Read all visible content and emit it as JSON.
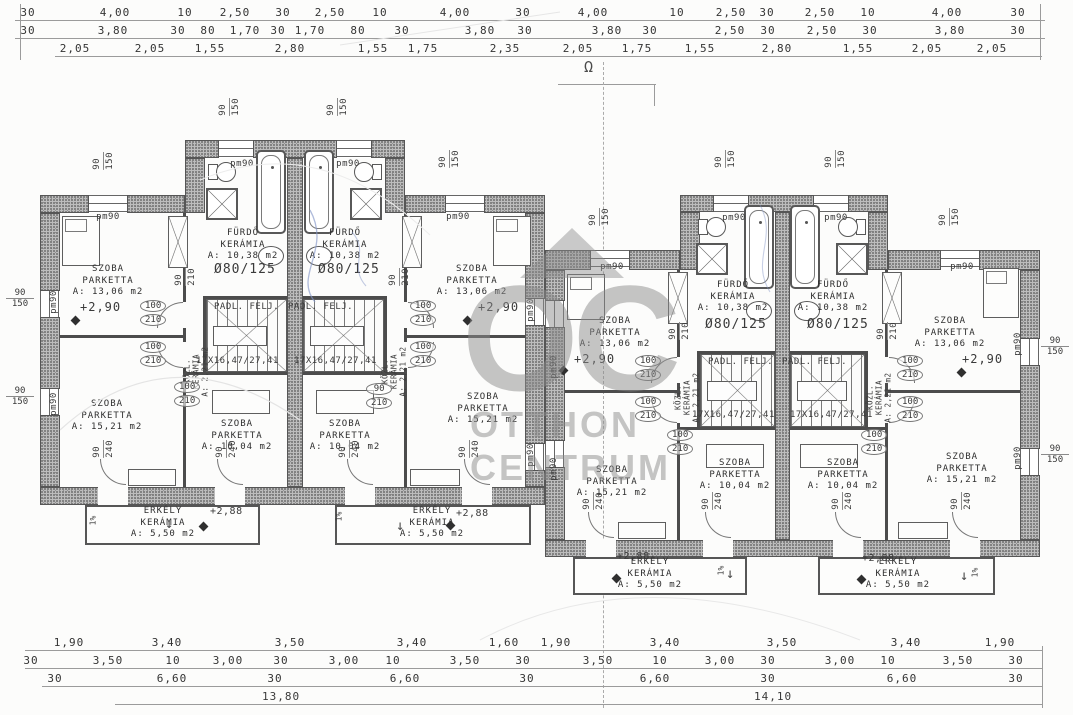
{
  "watermark": {
    "initials": "OC",
    "line1": "OTTHON",
    "line2": "CENTRUM"
  },
  "section_symbol": "Ω",
  "dimensions": {
    "top": {
      "row1": [
        "30",
        "4,00",
        "10",
        "2,50",
        "30",
        "2,50",
        "10",
        "4,00",
        "30",
        "4,00",
        "10",
        "2,50",
        "30",
        "2,50",
        "10",
        "4,00",
        "30"
      ],
      "row2": [
        "30",
        "3,80",
        "30",
        "80",
        "1,70",
        "30",
        "1,70",
        "80",
        "30",
        "3,80",
        "30",
        "3,80",
        "30",
        "2,50",
        "30",
        "2,50",
        "30",
        "3,80",
        "30"
      ],
      "row3": [
        "2,05",
        "2,05",
        "1,55",
        "2,80",
        "1,55",
        "1,75",
        "2,35",
        "2,05",
        "1,75",
        "1,55",
        "2,80",
        "1,55",
        "2,05",
        "2,05"
      ]
    },
    "bottom": {
      "row1": [
        "1,90",
        "3,40",
        "3,50",
        "3,40",
        "1,60",
        "1,90",
        "3,40",
        "3,50",
        "3,40",
        "1,90"
      ],
      "row2": [
        "30",
        "3,50",
        "10",
        "3,00",
        "30",
        "3,00",
        "10",
        "3,50",
        "30",
        "3,50",
        "10",
        "3,00",
        "30",
        "3,00",
        "10",
        "3,50",
        "30"
      ],
      "row3": [
        "30",
        "6,60",
        "30",
        "6,60",
        "30",
        "6,60",
        "30",
        "6,60",
        "30"
      ],
      "totals": {
        "left": "13,80",
        "right": "14,10"
      }
    }
  },
  "rooms": [
    {
      "name": "SZOBA",
      "finish": "PARKETTA",
      "area": "A: 13,06 m2"
    },
    {
      "name": "SZOBA",
      "finish": "PARKETTA",
      "area": "A: 15,21 m2"
    },
    {
      "name": "FÜRDŐ",
      "finish": "KERÁMIA",
      "area": "A: 10,38 m2"
    },
    {
      "name": "SZOBA",
      "finish": "PARKETTA",
      "area": "A: 10,04 m2"
    },
    {
      "name": "ERKÉLY",
      "finish": "KERÁMIA",
      "area": "A: 5,50 m2"
    },
    {
      "name": "SZOBA",
      "finish": "PARKETTA",
      "area": "A: 13,06 m2"
    },
    {
      "name": "SZOBA",
      "finish": "PARKETTA",
      "area": "A: 15,21 m2"
    },
    {
      "name": "FÜRDŐ",
      "finish": "KERÁMIA",
      "area": "A: 10,38 m2"
    },
    {
      "name": "SZOBA",
      "finish": "PARKETTA",
      "area": "A: 10,04 m2"
    },
    {
      "name": "ERKÉLY",
      "finish": "KERÁMIA",
      "area": "A: 5,50 m2"
    },
    {
      "name": "SZOBA",
      "finish": "PARKETTA",
      "area": "A: 13,06 m2"
    },
    {
      "name": "SZOBA",
      "finish": "PARKETTA",
      "area": "A: 15,21 m2"
    },
    {
      "name": "FÜRDŐ",
      "finish": "KERÁMIA",
      "area": "A: 10,38 m2"
    },
    {
      "name": "SZOBA",
      "finish": "PARKETTA",
      "area": "A: 10,04 m2"
    },
    {
      "name": "ERKÉLY",
      "finish": "KERÁMIA",
      "area": "A: 5,50 m2"
    },
    {
      "name": "SZOBA",
      "finish": "PARKETTA",
      "area": "A: 13,06 m2"
    },
    {
      "name": "SZOBA",
      "finish": "PARKETTA",
      "area": "A: 15,21 m2"
    },
    {
      "name": "FÜRDŐ",
      "finish": "KERÁMIA",
      "area": "A: 10,38 m2"
    },
    {
      "name": "SZOBA",
      "finish": "PARKETTA",
      "area": "A: 10,04 m2"
    },
    {
      "name": "ERKÉLY",
      "finish": "KERÁMIA",
      "area": "A: 5,50 m2"
    },
    {
      "name": "KÖZL.",
      "finish": "KERÁMIA",
      "area": "A: 2,21 m2"
    },
    {
      "name": "KÖZL.",
      "finish": "KERÁMIA",
      "area": "A: 2,21 m2"
    },
    {
      "name": "KÖZL.",
      "finish": "KERÁMIA",
      "area": "A: 2,21 m2"
    },
    {
      "name": "KÖZL.",
      "finish": "KERÁMIA",
      "area": "A: 2,21 m2"
    }
  ],
  "labels": {
    "stair_note": "PADL. FELJ.",
    "stair_spec": "17X16,47/27,41",
    "shower_spec": "Ø80/125",
    "level_floor": "+2,90",
    "level_balcony": "+2,88",
    "slope": "1%",
    "down_arrow": "↓"
  },
  "tags": {
    "pm90": "pm90",
    "door_w": "100",
    "door_h": "210",
    "door_narrow_w": "90",
    "balcony_door_w": "90",
    "balcony_door_h": "240",
    "window_w": "90",
    "window_h": "150"
  },
  "colors": {
    "wall_fill": "#bdbdbd",
    "plan_line": "#4c4c4c",
    "dim_text": "#343434",
    "watermark": "#8c8c8c",
    "pen_note": "#8496c8"
  }
}
